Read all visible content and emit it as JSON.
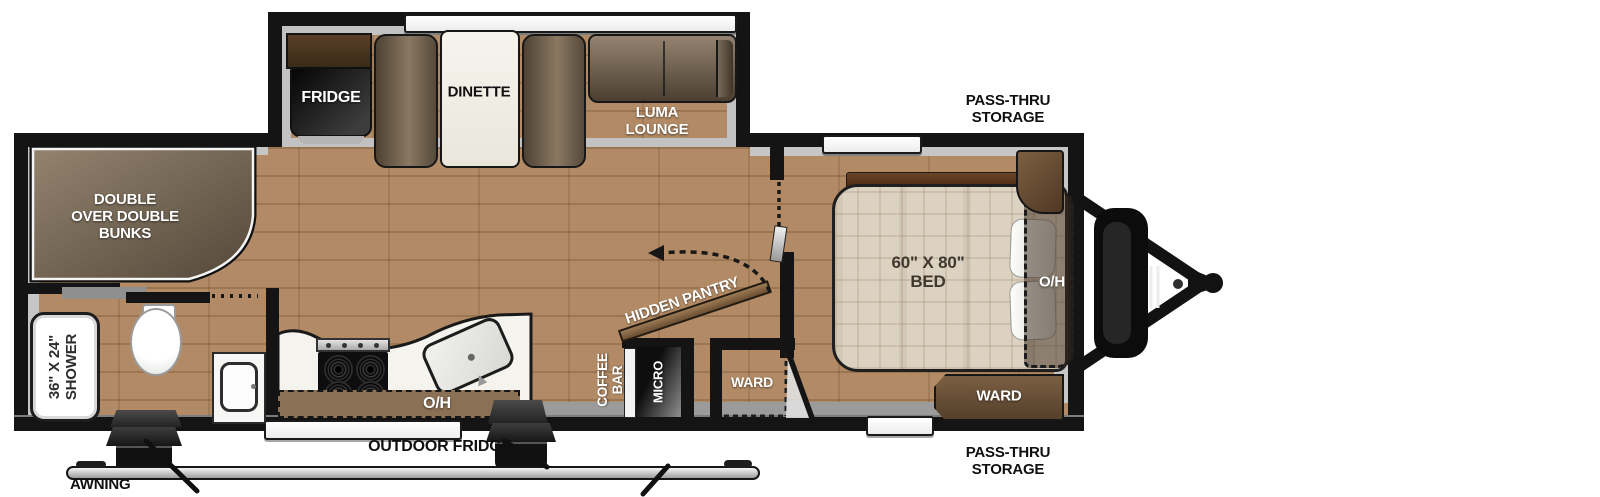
{
  "title": "Travel trailer floor plan",
  "colors": {
    "floor": "#b28b66",
    "wall": "#141414",
    "liner": "#c6c6c6",
    "counter": "#f5f3ed",
    "cabinet_brown": "#6e523a",
    "bed": "#dbd2c2",
    "sofa_brown": "#6b5b4a"
  },
  "floorplan": {
    "slideout": {
      "fridge": "FRIDGE",
      "dinette": "DINETTE",
      "lounge": "LUMA\nLOUNGE"
    },
    "bunk_room": {
      "bunks": "DOUBLE\nOVER DOUBLE\nBUNKS"
    },
    "bathroom": {
      "shower": "36\" X 24\"\nSHOWER"
    },
    "kitchen": {
      "overhead": "O/H",
      "hidden_pantry": "HIDDEN PANTRY",
      "coffee_bar": "COFFEE\nBAR",
      "micro": "MICRO"
    },
    "bedroom": {
      "bed": "60\" X 80\"\nBED",
      "overhead": "O/H",
      "ward": "WARD",
      "entry_ward": "WARD"
    },
    "exterior": {
      "pass_thru_storage_top": "PASS-THRU\nSTORAGE",
      "pass_thru_storage_bottom": "PASS-THRU\nSTORAGE",
      "outdoor_fridge": "OUTDOOR FRIDGE",
      "awning": "AWNING"
    }
  }
}
